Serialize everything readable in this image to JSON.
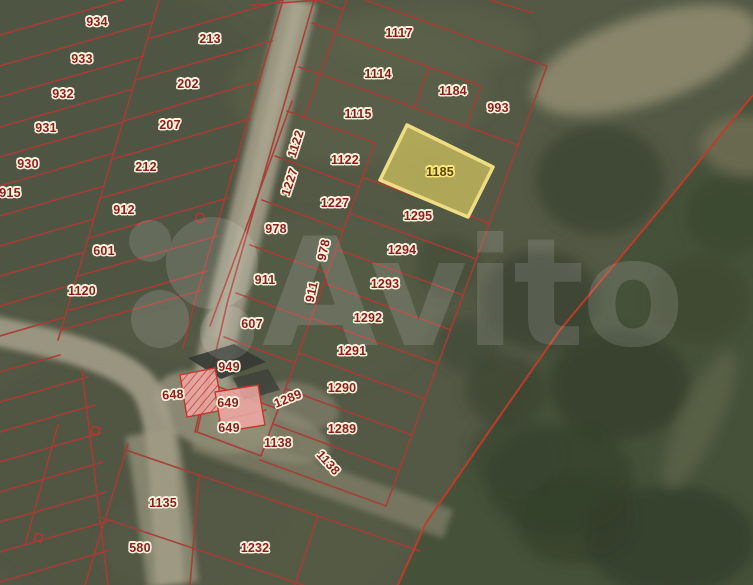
{
  "map": {
    "description": "satellite-cadastral-map",
    "watermark": {
      "text": "Avito"
    },
    "colors": {
      "parcel_line": "#a93c35",
      "boundary_line": "#c43a28",
      "label_text": "#8e1c1c",
      "label_halo": "#fdf4de",
      "highlight_fill": "#b7ae59",
      "highlight_border": "#eedd82",
      "highlight_label_text": "#5a4400",
      "highlight_label_halo": "#ffe97a",
      "building_fill": "#f0a8a4",
      "building_border": "#c0392b",
      "field": "#535945",
      "road": "#a6a08b",
      "forest": "#46513a"
    },
    "highlighted_parcel": {
      "id": "1185"
    },
    "labels": [
      {
        "text": "934",
        "x": 97,
        "y": 22,
        "rot": 0,
        "kind": "normal"
      },
      {
        "text": "933",
        "x": 82,
        "y": 59,
        "rot": 0,
        "kind": "normal"
      },
      {
        "text": "932",
        "x": 63,
        "y": 94,
        "rot": 0,
        "kind": "normal"
      },
      {
        "text": "931",
        "x": 46,
        "y": 128,
        "rot": 0,
        "kind": "normal"
      },
      {
        "text": "930",
        "x": 28,
        "y": 164,
        "rot": 0,
        "kind": "normal"
      },
      {
        "text": "915",
        "x": 10,
        "y": 193,
        "rot": 0,
        "kind": "normal"
      },
      {
        "text": "213",
        "x": 210,
        "y": 39,
        "rot": 0,
        "kind": "normal"
      },
      {
        "text": "202",
        "x": 188,
        "y": 84,
        "rot": 0,
        "kind": "normal"
      },
      {
        "text": "207",
        "x": 170,
        "y": 125,
        "rot": 0,
        "kind": "normal"
      },
      {
        "text": "212",
        "x": 146,
        "y": 167,
        "rot": 0,
        "kind": "normal"
      },
      {
        "text": "912",
        "x": 124,
        "y": 210,
        "rot": 0,
        "kind": "normal"
      },
      {
        "text": "601",
        "x": 104,
        "y": 251,
        "rot": 0,
        "kind": "normal"
      },
      {
        "text": "1120",
        "x": 82,
        "y": 291,
        "rot": 0,
        "kind": "normal"
      },
      {
        "text": "1117",
        "x": 399,
        "y": 33,
        "rot": 0,
        "kind": "normal"
      },
      {
        "text": "1114",
        "x": 378,
        "y": 74,
        "rot": 0,
        "kind": "normal"
      },
      {
        "text": "1184",
        "x": 453,
        "y": 91,
        "rot": 0,
        "kind": "normal"
      },
      {
        "text": "993",
        "x": 498,
        "y": 108,
        "rot": 0,
        "kind": "normal"
      },
      {
        "text": "1115",
        "x": 358,
        "y": 114,
        "rot": 0,
        "kind": "normal"
      },
      {
        "text": "1122",
        "x": 296,
        "y": 144,
        "rot": -72,
        "kind": "normal"
      },
      {
        "text": "1122",
        "x": 345,
        "y": 160,
        "rot": 0,
        "kind": "normal"
      },
      {
        "text": "1227",
        "x": 290,
        "y": 182,
        "rot": -72,
        "kind": "normal"
      },
      {
        "text": "1227",
        "x": 335,
        "y": 203,
        "rot": 0,
        "kind": "normal"
      },
      {
        "text": "1185",
        "x": 440,
        "y": 172,
        "rot": 0,
        "kind": "highlight"
      },
      {
        "text": "1295",
        "x": 418,
        "y": 216,
        "rot": 0,
        "kind": "normal"
      },
      {
        "text": "978",
        "x": 276,
        "y": 229,
        "rot": 0,
        "kind": "normal"
      },
      {
        "text": "978",
        "x": 324,
        "y": 250,
        "rot": -78,
        "kind": "normal"
      },
      {
        "text": "1294",
        "x": 402,
        "y": 250,
        "rot": 0,
        "kind": "normal"
      },
      {
        "text": "911",
        "x": 265,
        "y": 280,
        "rot": 0,
        "kind": "normal"
      },
      {
        "text": "911",
        "x": 312,
        "y": 292,
        "rot": -78,
        "kind": "normal"
      },
      {
        "text": "1293",
        "x": 385,
        "y": 284,
        "rot": 0,
        "kind": "normal"
      },
      {
        "text": "1292",
        "x": 368,
        "y": 318,
        "rot": 0,
        "kind": "normal"
      },
      {
        "text": "607",
        "x": 252,
        "y": 324,
        "rot": 0,
        "kind": "normal"
      },
      {
        "text": "1291",
        "x": 352,
        "y": 351,
        "rot": 0,
        "kind": "normal"
      },
      {
        "text": "949",
        "x": 229,
        "y": 367,
        "rot": 0,
        "kind": "normal"
      },
      {
        "text": "1290",
        "x": 342,
        "y": 388,
        "rot": 0,
        "kind": "normal"
      },
      {
        "text": "648",
        "x": 173,
        "y": 395,
        "rot": -4,
        "kind": "normal"
      },
      {
        "text": "1289",
        "x": 288,
        "y": 399,
        "rot": -22,
        "kind": "normal"
      },
      {
        "text": "649",
        "x": 228,
        "y": 403,
        "rot": 0,
        "kind": "normal"
      },
      {
        "text": "1289",
        "x": 342,
        "y": 429,
        "rot": 0,
        "kind": "normal"
      },
      {
        "text": "649",
        "x": 229,
        "y": 428,
        "rot": 0,
        "kind": "normal"
      },
      {
        "text": "1138",
        "x": 278,
        "y": 443,
        "rot": 0,
        "kind": "normal"
      },
      {
        "text": "1138",
        "x": 328,
        "y": 463,
        "rot": 48,
        "kind": "normal"
      },
      {
        "text": "1135",
        "x": 163,
        "y": 503,
        "rot": 0,
        "kind": "normal"
      },
      {
        "text": "580",
        "x": 140,
        "y": 548,
        "rot": 0,
        "kind": "normal"
      },
      {
        "text": "1232",
        "x": 255,
        "y": 548,
        "rot": 0,
        "kind": "normal"
      }
    ]
  }
}
